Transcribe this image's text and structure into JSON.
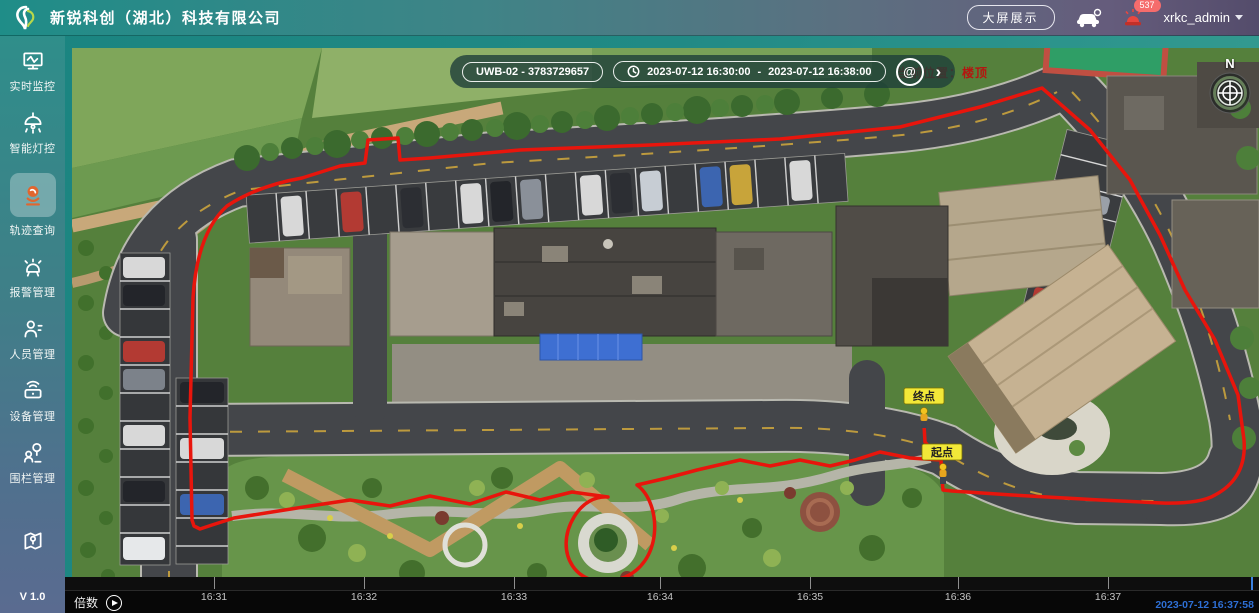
{
  "header": {
    "logo_icon": "swirl-logo",
    "company_name": "新锐科创（湖北）科技有限公司",
    "big_screen_button": "大屏展示",
    "patrol_car_icon": "patrol-car-icon",
    "siren_icon": "siren-icon",
    "alarm_badge": "537",
    "username": "xrkc_admin",
    "caret_icon": "caret-down-icon"
  },
  "sidebar": {
    "items": [
      {
        "label": "实时监控",
        "icon": "monitor-icon",
        "active": false
      },
      {
        "label": "智能灯控",
        "icon": "lamp-icon",
        "active": false
      },
      {
        "label": "轨迹查询",
        "icon": "track-icon",
        "active": true,
        "active_icon_color": "#e0662f"
      },
      {
        "label": "报警管理",
        "icon": "alarm-bell-icon",
        "active": false
      },
      {
        "label": "人员管理",
        "icon": "person-icon",
        "active": false
      },
      {
        "label": "设备管理",
        "icon": "device-icon",
        "active": false
      },
      {
        "label": "围栏管理",
        "icon": "fence-icon",
        "active": false
      },
      {
        "label": "",
        "icon": "map-icon",
        "active": false
      }
    ],
    "version": "V 1.0"
  },
  "toolbar": {
    "device_label": "UWB-02 - 3783729657",
    "clock_icon": "clock-icon",
    "time_start": "2023-07-12 16:30:00",
    "separator": "-",
    "time_end": "2023-07-12 16:38:00",
    "search_icon": "at-search-icon",
    "next_icon": "chevron-right-icon"
  },
  "map": {
    "location_label": "当前位置：楼顶",
    "compass_label": "N",
    "compass_icon": "compass-icon",
    "end_marker": "终点",
    "start_marker": "起点",
    "route_color": "#e8150c",
    "marker_bg": "#f2e838"
  },
  "timeline": {
    "speed_label": "倍数",
    "play_icon": "play-icon",
    "ticks": [
      "16:31",
      "16:32",
      "16:33",
      "16:34",
      "16:35",
      "16:36",
      "16:37"
    ],
    "current_time": "2023-07-12 16:37:58",
    "playhead_color": "#3b82e0"
  }
}
